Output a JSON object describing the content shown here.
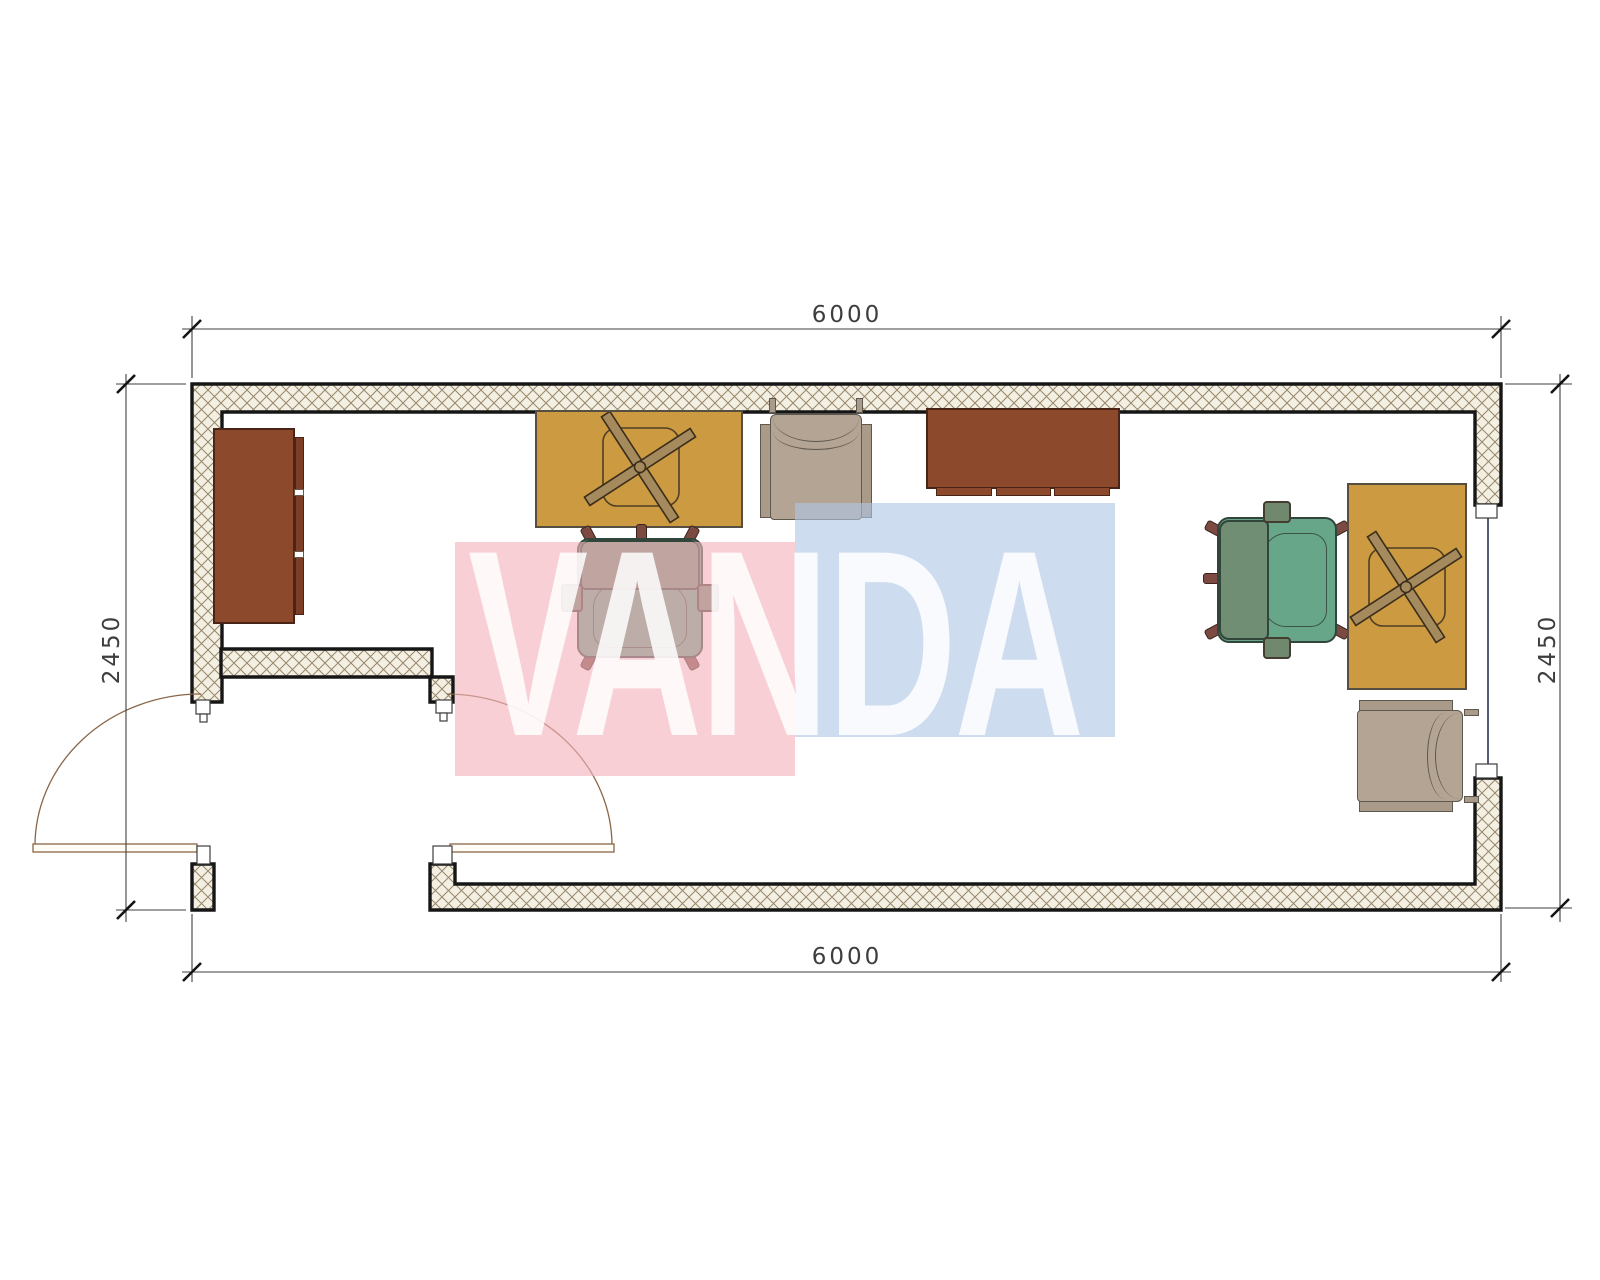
{
  "plan": {
    "title": "container-office-floor-plan",
    "dimensions": {
      "top": "6000",
      "bottom": "6000",
      "left": "2450",
      "right": "2450"
    },
    "watermark": {
      "text": "VANDA",
      "pink_color": "#f2b2bc",
      "blue_color": "#b0c7e5"
    },
    "walls": {
      "hatch_background": "#f3efe2",
      "hatch_line": "#97876a",
      "outline": "#161616"
    },
    "door": {
      "type": "double-swing-door",
      "arc_color": "#8a6647"
    },
    "window": {
      "type": "glazed-opening",
      "glazing_color": "#2b3350"
    },
    "furniture": [
      {
        "name": "tall-cabinet-left",
        "color": "#8d492c"
      },
      {
        "name": "desk-top",
        "color": "#cc9a40"
      },
      {
        "name": "guest-chair-top",
        "color": "#b3a493"
      },
      {
        "name": "office-chair-left",
        "color": "#67a689"
      },
      {
        "name": "sideboard-top",
        "color": "#8d492c"
      },
      {
        "name": "office-chair-right",
        "color": "#67a689"
      },
      {
        "name": "desk-right",
        "color": "#cc9a40"
      },
      {
        "name": "guest-chair-bottom",
        "color": "#b3a493"
      }
    ]
  }
}
